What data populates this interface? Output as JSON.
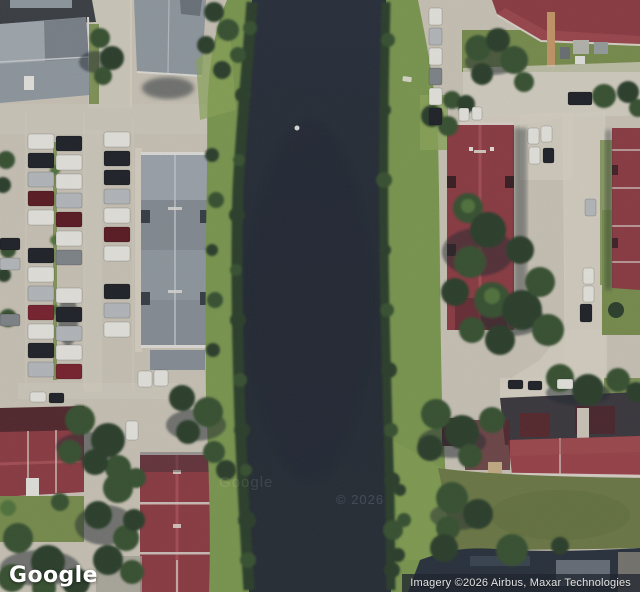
{
  "branding": {
    "logo_text": "Google"
  },
  "attribution": {
    "text": "Imagery ©2026 Airbus, Maxar Technologies"
  },
  "watermarks": {
    "google": "Google",
    "copyright": "© 2026"
  },
  "colors": {
    "pavement": "#cdc7ba",
    "pavement_light": "#dad4c7",
    "water": "#2a313d",
    "water_deep": "#252c37",
    "bank_grass": "#7e9b53",
    "bank_grass_light": "#8fa95c",
    "field_grass": "#6f7c49",
    "lawn": "#7b9150",
    "scrub": "#2e432e",
    "tree": "#3b5434",
    "tree_light": "#547741",
    "shadow": "#232a33",
    "roof_gray": "#949ca4",
    "roof_gray_light": "#aab1b8",
    "roof_gray_dark": "#7d858d",
    "roof_red": "#8f3e46",
    "roof_red_light": "#a85258",
    "roof_red_dark": "#552a30",
    "roof_red_bright": "#9c454c",
    "ridge_white": "#ddd5cc",
    "band_dark": "#2b3440",
    "attribution_bg": "rgba(33,39,48,0.78)",
    "attribution_text": "#e4e4e4",
    "logo_text": "#ffffff",
    "car_white": "#e9e8e3",
    "car_black": "#22252b",
    "car_silver": "#b9bdc1",
    "car_gray": "#83888d",
    "car_red": "#7c2531",
    "car_darkred": "#5e1d26",
    "car_blue": "#3c4a58"
  },
  "parking_rows": [
    {
      "x": 28,
      "y": 134,
      "w": 26,
      "h": 15,
      "gap": 4,
      "cars": [
        "white",
        "black",
        "silver",
        "darkred",
        "white",
        null,
        "black",
        "white",
        "silver",
        "red",
        "white",
        "black",
        "silver"
      ]
    },
    {
      "x": 56,
      "y": 136,
      "w": 26,
      "h": 15,
      "gap": 4,
      "cars": [
        "black",
        "white",
        "white",
        "silver",
        "darkred",
        "white",
        "gray",
        null,
        "white",
        "black",
        "silver",
        "white",
        "red"
      ]
    },
    {
      "x": 104,
      "y": 132,
      "w": 26,
      "h": 15,
      "gap": 4,
      "cars": [
        "white",
        "black",
        "black",
        "silver",
        "white",
        "darkred",
        "white",
        null,
        "black",
        "silver",
        "white"
      ]
    },
    {
      "x": 429,
      "y": 8,
      "w": 13,
      "h": 17,
      "gap": 3,
      "cars": [
        "white",
        "silver",
        "white",
        "gray",
        "white",
        "black"
      ]
    }
  ],
  "cars_free": [
    {
      "x": 0,
      "y": 238,
      "w": 20,
      "h": 12,
      "c": "black"
    },
    {
      "x": 0,
      "y": 258,
      "w": 20,
      "h": 12,
      "c": "silver"
    },
    {
      "x": 0,
      "y": 314,
      "w": 20,
      "h": 12,
      "c": "gray"
    },
    {
      "x": 30,
      "y": 392,
      "w": 16,
      "h": 10,
      "c": "white"
    },
    {
      "x": 49,
      "y": 393,
      "w": 15,
      "h": 10,
      "c": "black"
    },
    {
      "x": 138,
      "y": 371,
      "w": 14,
      "h": 16,
      "c": "white"
    },
    {
      "x": 154,
      "y": 370,
      "w": 14,
      "h": 16,
      "c": "white"
    },
    {
      "x": 126,
      "y": 421,
      "w": 12,
      "h": 19,
      "c": "white"
    },
    {
      "x": 459,
      "y": 108,
      "w": 10,
      "h": 13,
      "c": "white"
    },
    {
      "x": 472,
      "y": 107,
      "w": 10,
      "h": 13,
      "c": "white"
    },
    {
      "x": 528,
      "y": 128,
      "w": 11,
      "h": 16,
      "c": "white"
    },
    {
      "x": 541,
      "y": 126,
      "w": 11,
      "h": 16,
      "c": "white"
    },
    {
      "x": 529,
      "y": 147,
      "w": 11,
      "h": 17,
      "c": "white"
    },
    {
      "x": 543,
      "y": 148,
      "w": 11,
      "h": 15,
      "c": "black"
    },
    {
      "x": 568,
      "y": 92,
      "w": 24,
      "h": 13,
      "c": "black"
    },
    {
      "x": 585,
      "y": 199,
      "w": 11,
      "h": 17,
      "c": "silver"
    },
    {
      "x": 583,
      "y": 268,
      "w": 11,
      "h": 16,
      "c": "white"
    },
    {
      "x": 583,
      "y": 286,
      "w": 11,
      "h": 16,
      "c": "white"
    },
    {
      "x": 580,
      "y": 304,
      "w": 12,
      "h": 18,
      "c": "black"
    },
    {
      "x": 508,
      "y": 380,
      "w": 15,
      "h": 9,
      "c": "black"
    },
    {
      "x": 528,
      "y": 381,
      "w": 14,
      "h": 9,
      "c": "black"
    },
    {
      "x": 557,
      "y": 379,
      "w": 16,
      "h": 10,
      "c": "white"
    }
  ]
}
